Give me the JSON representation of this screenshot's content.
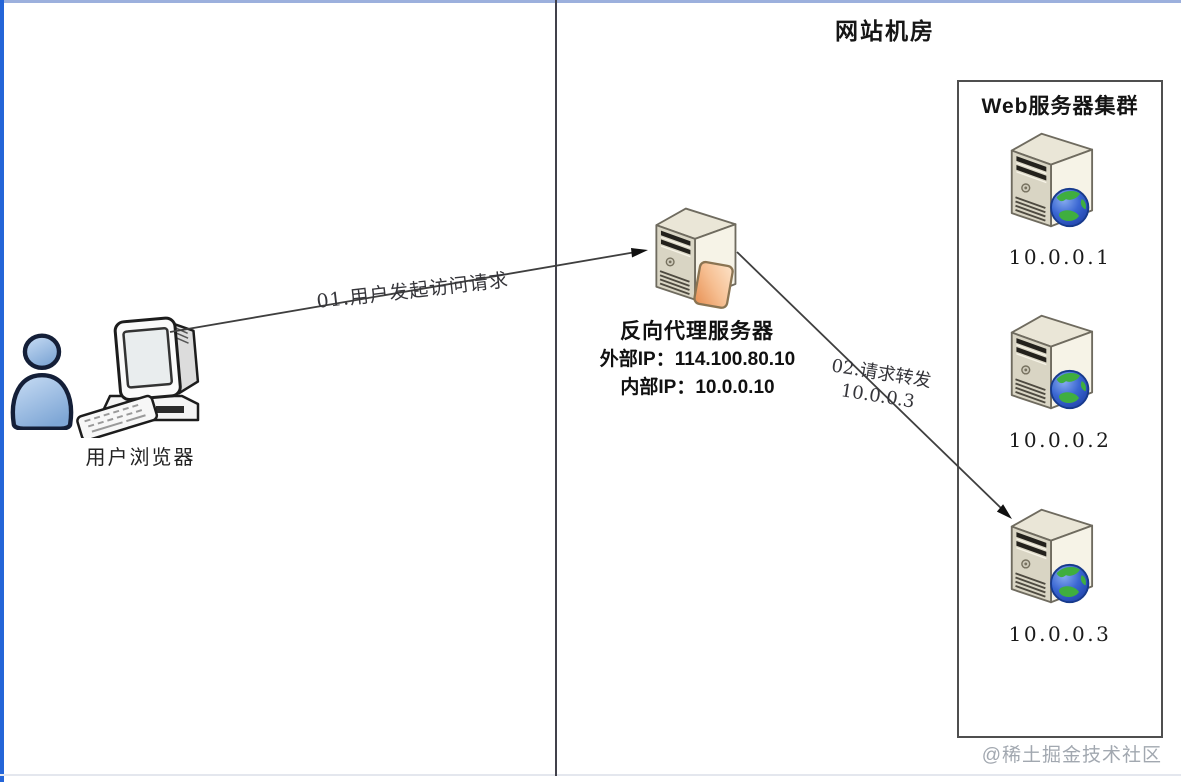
{
  "diagram": {
    "datacenter_title": "网站机房",
    "user": {
      "label": "用户浏览器",
      "icons": [
        "person-icon",
        "desktop-computer-icon",
        "keyboard-icon"
      ]
    },
    "proxy": {
      "name": "反向代理服务器",
      "external_ip_label": "外部IP：",
      "external_ip_value": "114.100.80.10",
      "internal_ip_label": "内部IP：",
      "internal_ip_value": "10.0.0.10",
      "icon": "tower-server-icon"
    },
    "cluster": {
      "title": "Web服务器集群",
      "servers": [
        {
          "ip": "10.0.0.1",
          "icon": "tower-server-globe-icon"
        },
        {
          "ip": "10.0.0.2",
          "icon": "tower-server-globe-icon"
        },
        {
          "ip": "10.0.0.3",
          "icon": "tower-server-globe-icon"
        }
      ]
    },
    "flows": [
      {
        "label": "01.用户发起访问请求"
      },
      {
        "label": "02.请求转发",
        "target_ip": "10.0.0.3"
      }
    ]
  },
  "watermark": "@稀土掘金技术社区",
  "colors": {
    "left_border": "#2465d8",
    "top_border": "#9cb0dd",
    "divider": "#41414b",
    "box_border": "#4f4f4f",
    "server_front": "#d9d5c4",
    "server_side": "#f6f3e7",
    "globe_blue": "#2b55c4",
    "globe_green": "#3fae3f",
    "panel_orange": "#ea9a5e",
    "person_blue": "#7fa7d6",
    "line": "#3f3f3f",
    "watermark": "#a2a8b0"
  }
}
